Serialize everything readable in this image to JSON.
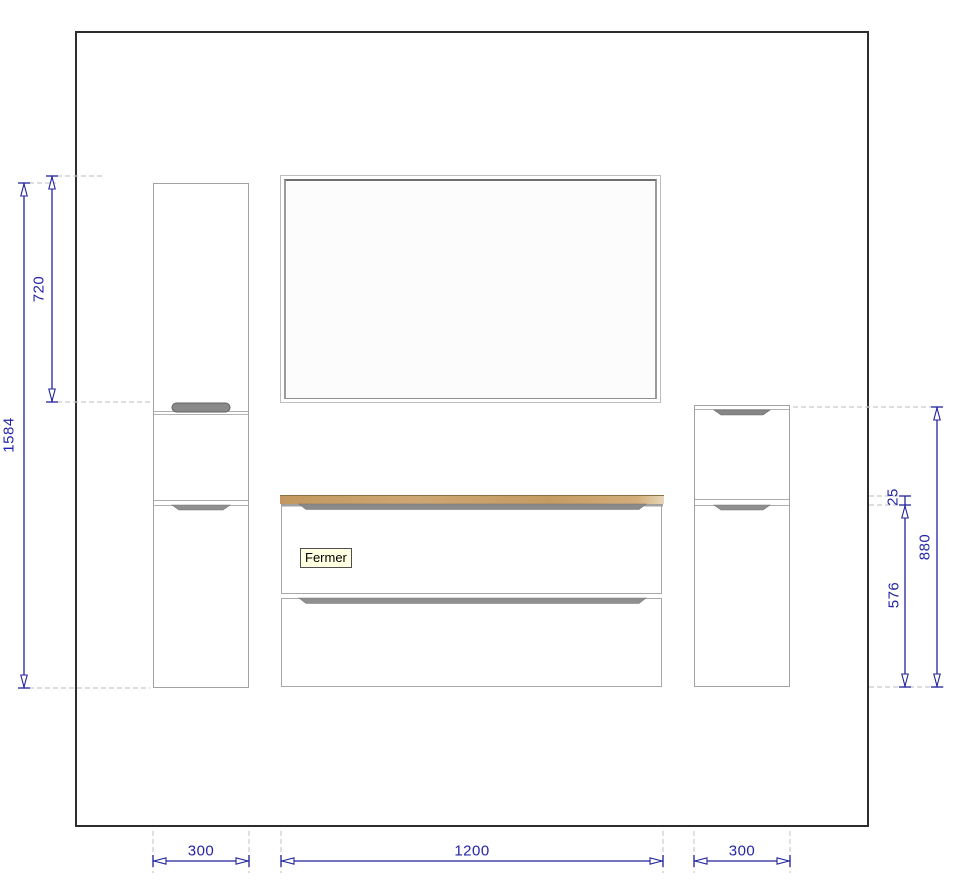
{
  "tooltip": {
    "label": "Fermer"
  },
  "dimensions": {
    "left_column_height": "1584",
    "mirror_height": "720",
    "countertop_thickness": "25",
    "right_column_height": "880",
    "vanity_height": "576",
    "left_column_width": "300",
    "vanity_width": "1200",
    "right_column_width": "300"
  },
  "colors": {
    "dimension_line": "#22229e",
    "dimension_text": "#2424a8",
    "extension_line": "#cbcbcb",
    "wall": "#2d2d2d",
    "furniture_outline": "#a2a2a2",
    "handle": "#8a8a8a",
    "countertop_wood": "#c79e66",
    "tooltip_background": "#ffffe1"
  }
}
